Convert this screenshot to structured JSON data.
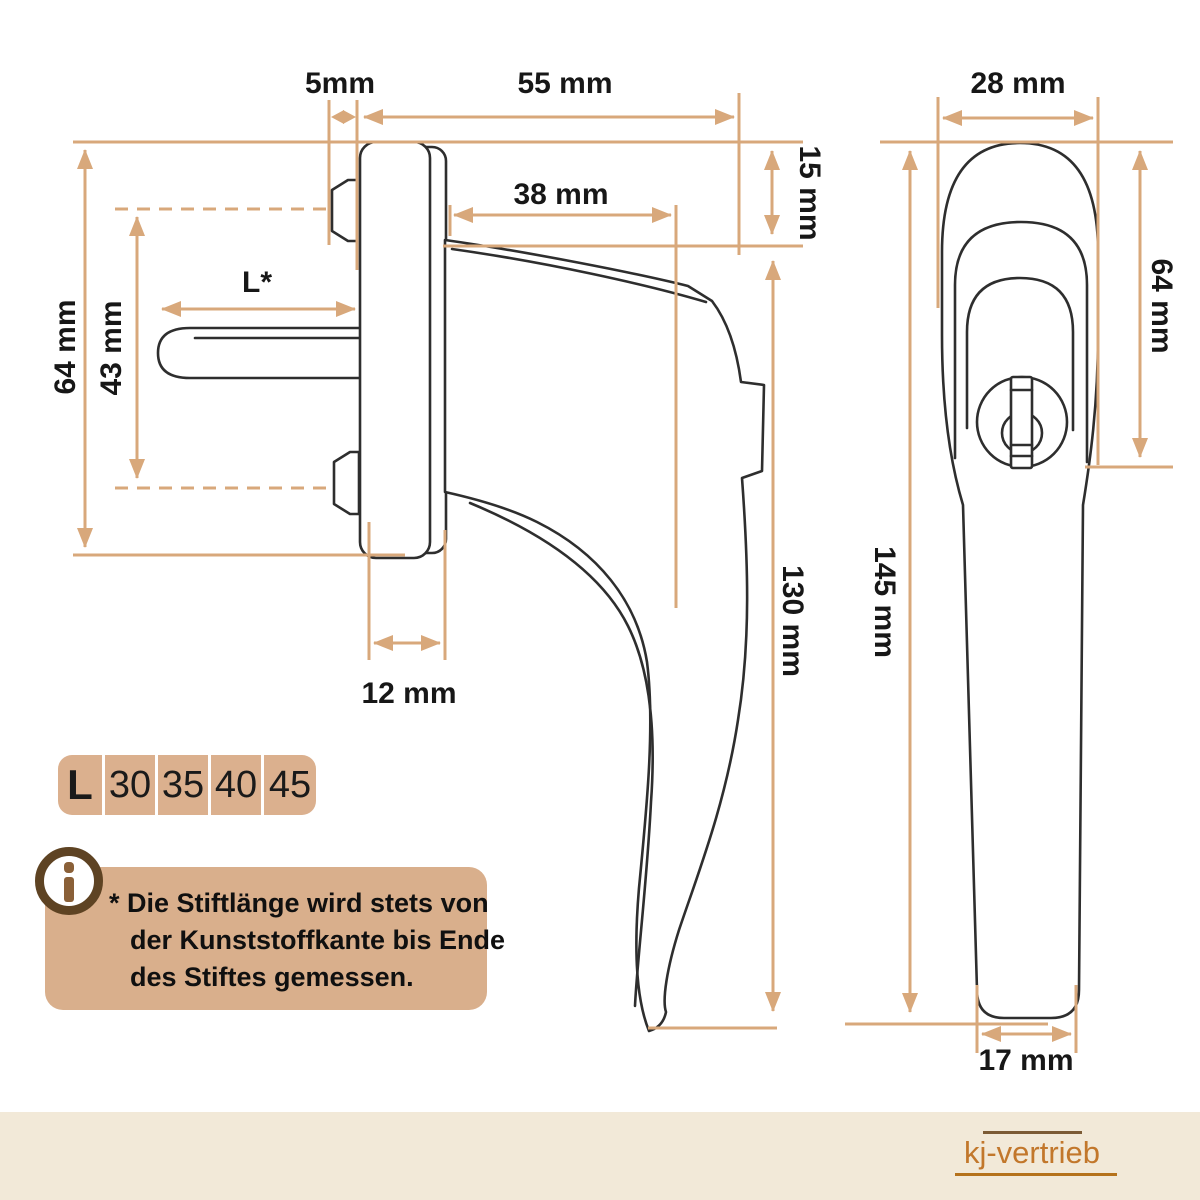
{
  "side_view": {
    "labels": {
      "pin_protrusion": "5mm",
      "base_width": "55 mm",
      "neck_length": "38 mm",
      "cap_depth": "15 mm",
      "rosette_height": "64 mm",
      "screw_distance": "43 mm",
      "pin_length": "L*",
      "handle_height": "130 mm",
      "base_depth": "12 mm"
    }
  },
  "front_view": {
    "labels": {
      "head_width": "28 mm",
      "head_height": "64 mm",
      "total_length": "145 mm",
      "grip_width": "17 mm"
    }
  },
  "size_table": {
    "label": "L",
    "options": [
      "30",
      "35",
      "40",
      "45"
    ]
  },
  "info_note": {
    "icon": "info-icon",
    "line1": "* Die Stiftlänge wird stets von",
    "line2": "der Kunststoffkante bis Ende",
    "line3": "des Stiftes gemessen."
  },
  "footer": {
    "brand": "kj-vertrieb"
  },
  "colors": {
    "dim": "#D8A87B",
    "ink": "#2E2E2E",
    "cell": "#DBB08E",
    "note": "#D9AF8C",
    "band": "#F2E9D8",
    "ring": "#5E4323",
    "itext": "#8A6038",
    "brand": "#C2772B",
    "ruletop": "#7C5B35",
    "rulebottom": "#B5721C"
  }
}
